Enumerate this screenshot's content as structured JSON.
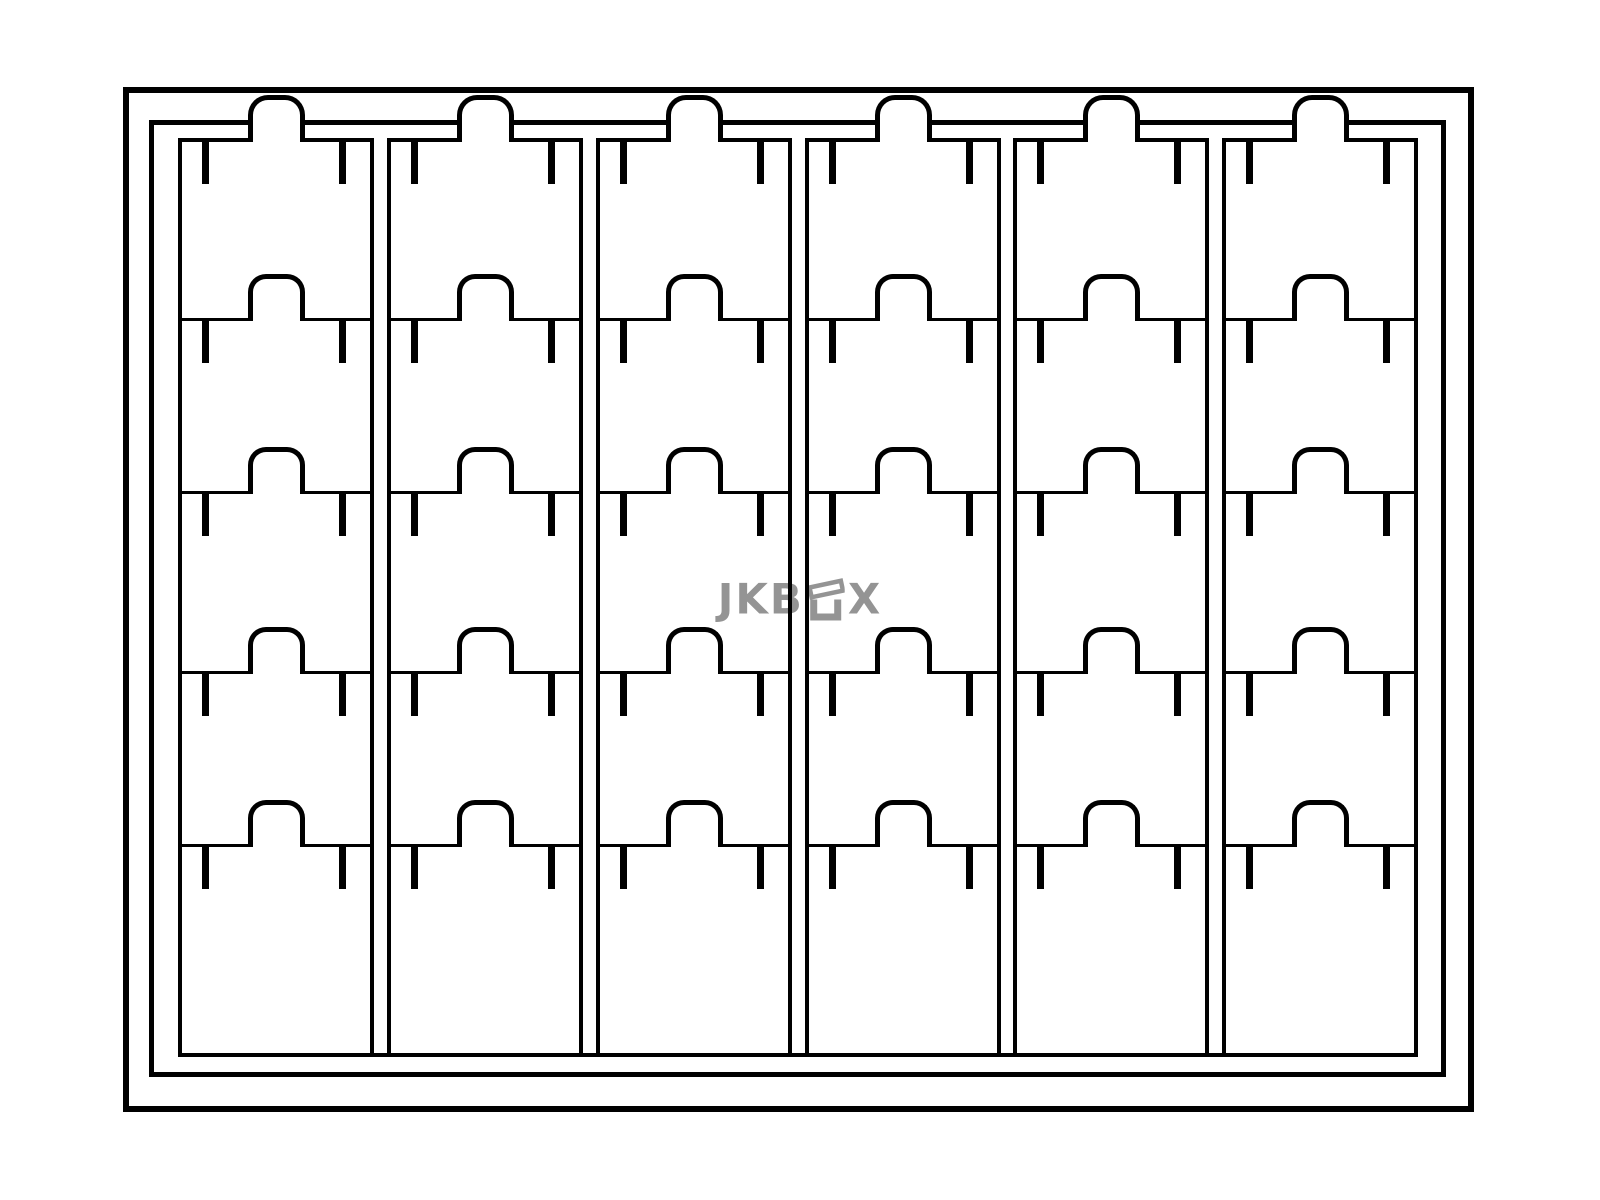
{
  "canvas": {
    "width": 1600,
    "height": 1200,
    "background": "#ffffff",
    "line_color": "#000000"
  },
  "watermark": {
    "text_left": "JKB",
    "text_right": "X",
    "icon": "open-box-icon",
    "color": "#949494",
    "x": 800,
    "y": 599
  },
  "diagram": {
    "description": "Line drawing of a card storage box: six columns of five tabbed index cards inside a double-walled case",
    "outer_frame": {
      "x": 123,
      "y": 87,
      "width": 1351,
      "height": 1025,
      "stroke": 6
    },
    "inner_frame": {
      "x": 149,
      "y": 120,
      "width": 1297,
      "height": 957,
      "stroke": 5
    },
    "columns": {
      "count": 6,
      "x_positions": [
        178,
        387,
        596,
        805,
        1013,
        1222
      ],
      "width": 196,
      "top_y": 138,
      "bottom_y": 1057,
      "side_stroke": 4
    },
    "rows": {
      "count": 5,
      "boundary_y": [
        138,
        318,
        491,
        671,
        844
      ],
      "top_edge_stroke": 4,
      "divider_stroke": 3
    },
    "base_line": {
      "x": 178,
      "y": 1053,
      "width": 1240,
      "stroke": 4
    },
    "tab": {
      "width": 57,
      "height": 47,
      "stroke": 5,
      "top_tab_y": 95,
      "rise_above_divider": 44,
      "center_offset": 98
    },
    "tick": {
      "width": 7,
      "height": 42,
      "left_offset": 24,
      "right_offset": 35
    }
  }
}
